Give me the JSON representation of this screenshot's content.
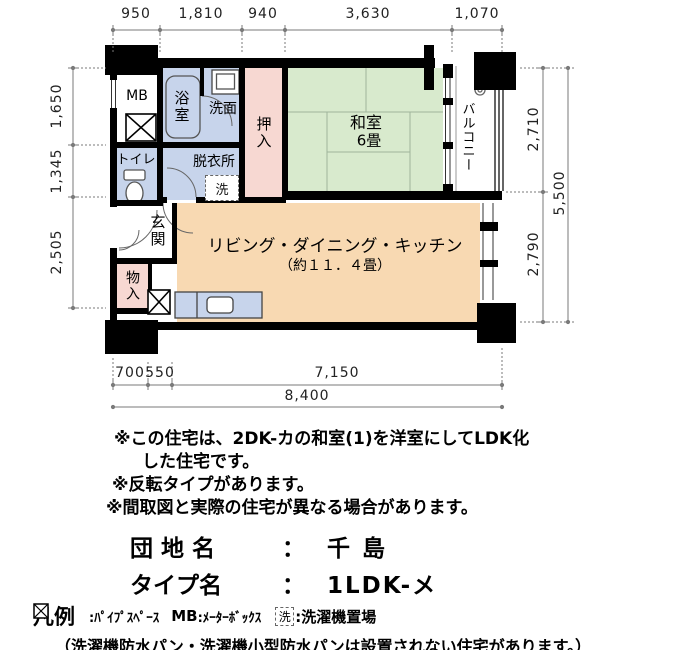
{
  "plan": {
    "labels": {
      "mb": "MB",
      "bath": "浴室",
      "washstand": "洗面",
      "oshiire": "押入",
      "washitsu_name": "和室",
      "washitsu_size": "6畳",
      "balcony": "バルコニー",
      "toilet": "トイレ",
      "dressing": "脱衣所",
      "laundry": "洗",
      "entrance": "玄関",
      "storage": "物入",
      "ldk_name": "リビング・ダイニング・キッチン",
      "ldk_size": "（約１１．４畳）"
    },
    "colors": {
      "wet": "#c7d4eb",
      "tatami": "#d8eacd",
      "closet": "#f7d8d2",
      "ldk": "#f8d9b2",
      "wall": "#000000",
      "dimension": "#7a7a7a"
    }
  },
  "dimensions": {
    "top": [
      "950",
      "1,810",
      "940",
      "3,630",
      "1,070"
    ],
    "left": [
      "1,650",
      "1,345",
      "2,505"
    ],
    "right": [
      "2,710",
      "2,790"
    ],
    "right_total": "5,500",
    "bottom": [
      "700",
      "550",
      "7,150"
    ],
    "bottom_total": "8,400"
  },
  "notes": {
    "line1": "※この住宅は、2DK-カの和室(1)を洋室にしてLDK化",
    "line2": "した住宅です。",
    "line3": "※反転タイプがあります。",
    "line4": "※間取図と実際の住宅が異なる場合があります。"
  },
  "estate": {
    "name_label": "団 地 名",
    "separator": "：",
    "name_value": "千 島",
    "type_label": "タイプ名",
    "type_value": "1LDK-メ"
  },
  "legend": {
    "title": "凡例",
    "pipe_text": ":ﾊﾟｲﾌﾟｽﾍﾟｰｽ",
    "mb_key": "MB",
    "mb_text": ":ﾒｰﾀｰﾎﾞｯｸｽ",
    "laundry_key": "洗",
    "laundry_text": ":洗濯機置場",
    "note": "（洗濯機防水パン・洗濯機小型防水パンは設置されない住宅があります。）"
  }
}
